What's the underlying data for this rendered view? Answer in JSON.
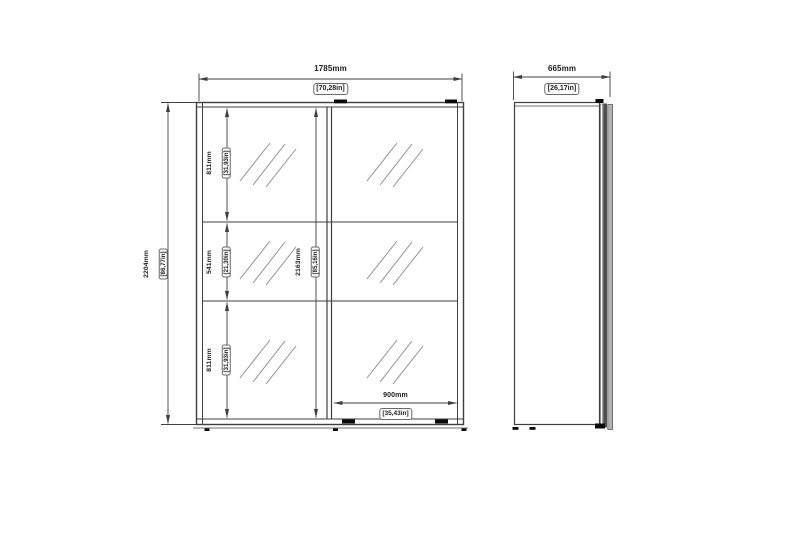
{
  "front_view": {
    "overall_width": {
      "mm": "1785mm",
      "inch": "[70,28in]"
    },
    "overall_height": {
      "mm": "2204mm",
      "inch": "[86,77in]"
    },
    "interior_height": {
      "mm": "2163mm",
      "inch": "[85,16in]"
    },
    "top_section_height": {
      "mm": "811mm",
      "inch": "[31,93in]"
    },
    "middle_section_height": {
      "mm": "541mm",
      "inch": "[21,30in]"
    },
    "bottom_section_height": {
      "mm": "811mm",
      "inch": "[31,93in]"
    },
    "door_width": {
      "mm": "900mm",
      "inch": "[35,43in]"
    }
  },
  "side_view": {
    "depth": {
      "mm": "665mm",
      "inch": "[26,17in]"
    }
  },
  "colors": {
    "background": "#ffffff",
    "line": "#3f3f3f",
    "hatch": "#8a8a8a",
    "text": "#1c1c1c",
    "roller_mark": "#0a0a0a",
    "door_panel_dark": "#4f4f4f",
    "door_panel_light": "#b3b3b3"
  }
}
